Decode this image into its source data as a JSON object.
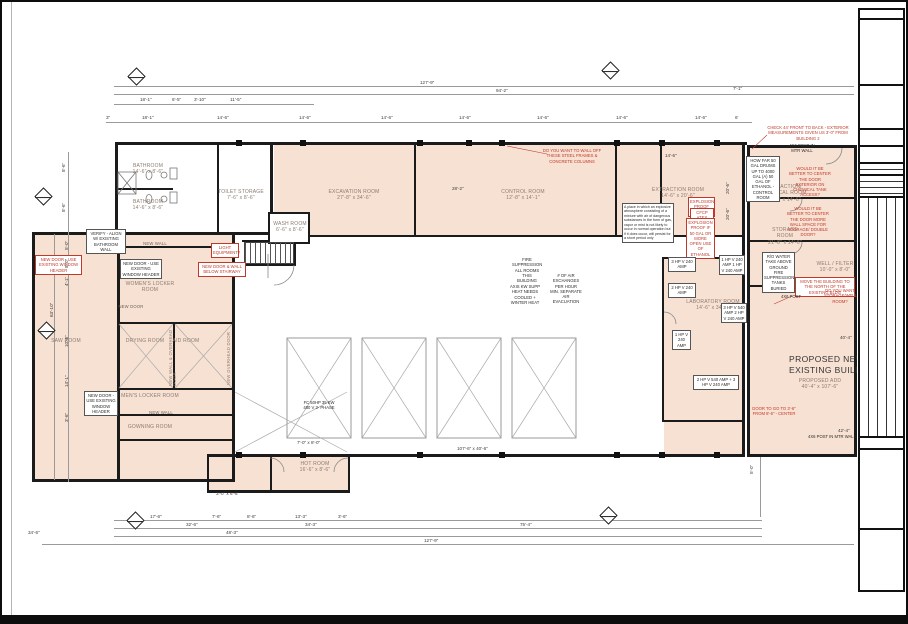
{
  "palette": {
    "room_fill": "#f7e1d3",
    "wall": "#1b1b1b",
    "red": "#c0392b",
    "dim_text": "#3c3c3c",
    "label_text": "#8d7b70"
  },
  "big_label": {
    "l1": "PROPOSED NEW B",
    "l2": "EXISTING BUILDINGS"
  },
  "labels": [
    {
      "t": "BATHROOM",
      "d": "14'-6\" x 8'-6\"",
      "x": 116,
      "y": 161,
      "w": 60
    },
    {
      "t": "BATHROOM",
      "d": "14'-6\" x 8'-6\"",
      "x": 116,
      "y": 197,
      "w": 60
    },
    {
      "t": "TOILET STORAGE",
      "d": "7'-6\" x 8'-6\"",
      "x": 211,
      "y": 187,
      "w": 56
    },
    {
      "t": "WASH ROOM",
      "d": "6'-6\" x 8'-6\"",
      "x": 266,
      "y": 219,
      "w": 44
    },
    {
      "t": "EXCAVATION ROOM",
      "d": "27'-8\" x 34'-6\"",
      "x": 320,
      "y": 187,
      "w": 64
    },
    {
      "t": "CONTROL ROOM",
      "d": "12'-8\" x 14'-1\"",
      "x": 494,
      "y": 187,
      "w": 54
    },
    {
      "t": "EXTRACTION ROOM",
      "d": "14'-6\" x 20'-6\"",
      "x": 648,
      "y": 185,
      "w": 56
    },
    {
      "t": "EXTRACTION/ CHEMICAL ROOM",
      "d": "21'-8\" x 14'-6\"",
      "x": 758,
      "y": 182,
      "w": 48
    },
    {
      "t": "STORAGE ROOM",
      "d": "21'-8\" x 14'-6\"",
      "x": 762,
      "y": 225,
      "w": 42
    },
    {
      "t": "LABORATORY ROOM",
      "d": "14'-6\" x 34'-6\"",
      "x": 682,
      "y": 297,
      "w": 58
    },
    {
      "t": "WOMEN'S LOCKER ROOM",
      "d": "",
      "x": 118,
      "y": 279,
      "w": 60
    },
    {
      "t": "DRYING ROOM",
      "d": "",
      "x": 116,
      "y": 336,
      "w": 54
    },
    {
      "t": "AID ROOM",
      "d": "",
      "x": 158,
      "y": 336,
      "w": 52
    },
    {
      "t": "MEN'S LOCKER ROOM",
      "d": "",
      "x": 118,
      "y": 391,
      "w": 60
    },
    {
      "t": "GOWNING ROOM",
      "d": "",
      "x": 118,
      "y": 422,
      "w": 60
    },
    {
      "t": "SAW ROOM",
      "d": "",
      "x": 36,
      "y": 336,
      "w": 56
    },
    {
      "t": "HOT ROOM",
      "d": "16'-6\" x 8'-6\"",
      "x": 284,
      "y": 459,
      "w": 58
    },
    {
      "t": "WELL / FILTER",
      "d": "10'-0\" x 8'-0\"",
      "x": 814,
      "y": 259,
      "w": 38
    },
    {
      "t": "PROPOSED ADD",
      "d": "40'-4\" x 107'-6\"",
      "x": 796,
      "y": 376,
      "w": 44
    },
    {
      "t": "NEW WALL",
      "d": "",
      "x": 138,
      "y": 239,
      "w": 30,
      "cls": "sm"
    },
    {
      "t": "NEW DOOR",
      "d": "",
      "x": 114,
      "y": 302,
      "w": 30,
      "cls": "sm"
    },
    {
      "t": "NEW WALL",
      "d": "",
      "x": 144,
      "y": 408,
      "w": 30,
      "cls": "sm"
    }
  ],
  "vlabels": [
    {
      "t": "NEW WALL & OVERHEAD DOOR",
      "x": 167,
      "y": 324,
      "h": 60
    },
    {
      "t": "NEW OVERHEAD DOOR",
      "x": 225,
      "y": 327,
      "h": 56
    }
  ],
  "red_notes": [
    {
      "t": "DO YOU WANT TO WALL OFF THESE STEEL FRAMES & CONCRETE COLUMNS",
      "x": 538,
      "y": 146,
      "w": 64
    },
    {
      "t": "CHECK 44' FRONT TO BACK - EXTERIOR MEASUREMENTS GIVEN US 3'-0\" FROM BUILDING 2",
      "x": 762,
      "y": 123,
      "w": 88
    },
    {
      "t": "WOULD IT BE BETTER TO CENTER THE DOOR EXTERIOR ON CHEMICAL TANK ACCESS?",
      "x": 786,
      "y": 164,
      "w": 44
    },
    {
      "t": "WOULD IT BE BETTER TO CENTER THE DOOR MORE WALL SPACE FOR STORAGE/ DOUBLE DOOR?",
      "x": 784,
      "y": 204,
      "w": 44
    },
    {
      "t": "EXPLOSION PROOF ROOM",
      "x": 686,
      "y": 195,
      "w": 27,
      "cls": "boxr"
    },
    {
      "t": "CFCP ATEX ZONE 2",
      "x": 688,
      "y": 206,
      "w": 24,
      "cls": "boxr"
    },
    {
      "t": "EXPLOSION PROOF IF 50 GAL OR MORE OPEN USE OF ETHANOL",
      "x": 684,
      "y": 216,
      "w": 29,
      "cls": "boxr"
    },
    {
      "t": "LIGHT EQUIPMENT?",
      "x": 209,
      "y": 241,
      "w": 28,
      "cls": "boxr"
    },
    {
      "t": "NEW DOOR & WALL BELOW STAIRWAY",
      "x": 196,
      "y": 260,
      "w": 48,
      "cls": "boxr"
    },
    {
      "t": "NEW DOOR - USE EXISTING WINDOW HEADER",
      "x": 33,
      "y": 253,
      "w": 47,
      "cls": "boxr"
    },
    {
      "t": "MOVE THE BUILDING TO THE NORTH OF THE EXISTING BLDG",
      "x": 793,
      "y": 275,
      "w": 60,
      "cls": "boxr"
    },
    {
      "t": "DO YOU WANT STORAGE/WELL ROOM?",
      "x": 822,
      "y": 286,
      "w": 32
    },
    {
      "t": "DOOR TO GO TO 3'-6\" FROM 8'-6\" - CENTER",
      "x": 748,
      "y": 404,
      "w": 48
    }
  ],
  "black_notes": [
    {
      "t": "VERIFY - ALIGN W/ EXISTING BATHROOM WALL",
      "x": 84,
      "y": 227,
      "w": 40
    },
    {
      "t": "NEW DOOR - USE EXISTING WINDOW HEADER",
      "x": 118,
      "y": 257,
      "w": 42
    },
    {
      "t": "NEW DOOR - USE EXISTING WINDOW HEADER",
      "x": 82,
      "y": 389,
      "w": 34
    },
    {
      "t": "HOW FAR 50 GAL DRUMS UP TO 4000 GAL (A) 50 GAL OF ETHANOL - CONTROL ROOM",
      "x": 744,
      "y": 154,
      "w": 34
    },
    {
      "t": "R/O WATER TAKE ABOVE GROUND FIRE SUPPRESSION TANKS BURIED",
      "x": 760,
      "y": 250,
      "w": 33
    },
    {
      "t": "A place in which an explosive atmosphere consisting of a mixture with air of dangerous substances in the form of gas, vapor or mist is not likely to occur in normal operation but if it does occur, will persist for a short period only",
      "x": 620,
      "y": 201,
      "w": 52,
      "cls": "tiny"
    },
    {
      "t": "3 HP V 240 AMP",
      "x": 666,
      "y": 255,
      "w": 28
    },
    {
      "t": "1 HP V 240 AMP 1 HP V 240 AMP",
      "x": 717,
      "y": 253,
      "w": 26
    },
    {
      "t": "2 HP V 240 AMP",
      "x": 666,
      "y": 281,
      "w": 28
    },
    {
      "t": "3 HP V 540 AMP 2 HP V 240 AMP",
      "x": 719,
      "y": 301,
      "w": 26
    },
    {
      "t": "1 HP V 240 AMP",
      "x": 670,
      "y": 328,
      "w": 19
    },
    {
      "t": "2 HP V 540 AMP + 3 HP V 240 AMP",
      "x": 691,
      "y": 373,
      "w": 46
    }
  ],
  "free_notes": [
    {
      "t": "FIRE SUPPRESSION ALL ROOMS THIS BUILDING",
      "x": 510,
      "y": 255,
      "w": 30
    },
    {
      "t": "# OF AIR EXCHANGES PER HOUR MIN. SEPARATE AIR EVACUATION",
      "x": 548,
      "y": 271,
      "w": 32
    },
    {
      "t": "AXIS KW SUPP HEAT NEEDS COOLED + WINTER HEAT",
      "x": 507,
      "y": 282,
      "w": 32
    },
    {
      "t": "FC 50HP 35 KW 480 V 3- PHASE",
      "x": 300,
      "y": 398,
      "w": 34
    },
    {
      "t": "4X6 POST IN MTR WALL",
      "x": 786,
      "y": 141,
      "w": 28
    },
    {
      "t": "4X6 POST",
      "x": 776,
      "y": 292,
      "w": 26
    },
    {
      "t": "4X6 POST IN MTR WALL",
      "x": 806,
      "y": 432,
      "w": 48
    }
  ],
  "dims": [
    {
      "t": "127'-9\"",
      "x": 418,
      "y": 79
    },
    {
      "t": "94'-2\"",
      "x": 494,
      "y": 87
    },
    {
      "t": "7'-1\"",
      "x": 731,
      "y": 85
    },
    {
      "t": "18'-1\"",
      "x": 138,
      "y": 96
    },
    {
      "t": "6'-5\"",
      "x": 170,
      "y": 96
    },
    {
      "t": "3'-10\"",
      "x": 192,
      "y": 96
    },
    {
      "t": "11'-5\"",
      "x": 228,
      "y": 96
    },
    {
      "t": "3\"",
      "x": 104,
      "y": 114
    },
    {
      "t": "18'-1\"",
      "x": 140,
      "y": 114
    },
    {
      "t": "14'-6\"",
      "x": 215,
      "y": 114
    },
    {
      "t": "14'-6\"",
      "x": 297,
      "y": 114
    },
    {
      "t": "14'-6\"",
      "x": 379,
      "y": 114
    },
    {
      "t": "14'-6\"",
      "x": 457,
      "y": 114
    },
    {
      "t": "14'-6\"",
      "x": 535,
      "y": 114
    },
    {
      "t": "14'-6\"",
      "x": 614,
      "y": 114
    },
    {
      "t": "14'-6\"",
      "x": 693,
      "y": 114
    },
    {
      "t": "6'",
      "x": 733,
      "y": 114
    },
    {
      "t": "14'-6\"",
      "x": 663,
      "y": 152
    },
    {
      "t": "28'-2\"",
      "x": 450,
      "y": 185
    },
    {
      "t": "20'-6\"",
      "x": 724,
      "y": 192,
      "r": 1
    },
    {
      "t": "20'-6\"",
      "x": 724,
      "y": 218,
      "r": 1
    },
    {
      "t": "8'-6\"",
      "x": 60,
      "y": 170,
      "r": 1
    },
    {
      "t": "8'-6\"",
      "x": 60,
      "y": 210,
      "r": 1
    },
    {
      "t": "5'-0\"",
      "x": 63,
      "y": 248,
      "r": 1
    },
    {
      "t": "8'-0\"",
      "x": 63,
      "y": 266,
      "r": 1
    },
    {
      "t": "4'-1\"",
      "x": 63,
      "y": 284,
      "r": 1
    },
    {
      "t": "63'-10\"",
      "x": 48,
      "y": 315,
      "r": 1
    },
    {
      "t": "10'-6\"",
      "x": 63,
      "y": 345,
      "r": 1
    },
    {
      "t": "14'-1\"",
      "x": 63,
      "y": 385,
      "r": 1
    },
    {
      "t": "3'-6\"",
      "x": 63,
      "y": 420,
      "r": 1
    },
    {
      "t": "17'-6\"",
      "x": 148,
      "y": 513
    },
    {
      "t": "7'-6\"",
      "x": 210,
      "y": 513
    },
    {
      "t": "8'-6\"",
      "x": 245,
      "y": 513
    },
    {
      "t": "13'-3\"",
      "x": 293,
      "y": 513
    },
    {
      "t": "3'-6\"",
      "x": 336,
      "y": 513
    },
    {
      "t": "32'-6\"",
      "x": 184,
      "y": 521
    },
    {
      "t": "34'-3\"",
      "x": 303,
      "y": 521
    },
    {
      "t": "75'-4\"",
      "x": 518,
      "y": 521
    },
    {
      "t": "48'-3\"",
      "x": 224,
      "y": 529
    },
    {
      "t": "127'-9\"",
      "x": 422,
      "y": 537
    },
    {
      "t": "34'-6\"",
      "x": 26,
      "y": 529
    },
    {
      "t": "40'-4\"",
      "x": 838,
      "y": 334
    },
    {
      "t": "42'-4\"",
      "x": 836,
      "y": 427
    },
    {
      "t": "5'-0\"",
      "x": 748,
      "y": 472,
      "r": 1
    },
    {
      "t": "107'-6\" x 40'-6\"",
      "x": 455,
      "y": 445
    },
    {
      "t": "7'-0\" x 8'-0\"",
      "x": 295,
      "y": 439
    },
    {
      "t": "3'-0\" x 6'-8\"",
      "x": 214,
      "y": 490
    }
  ]
}
